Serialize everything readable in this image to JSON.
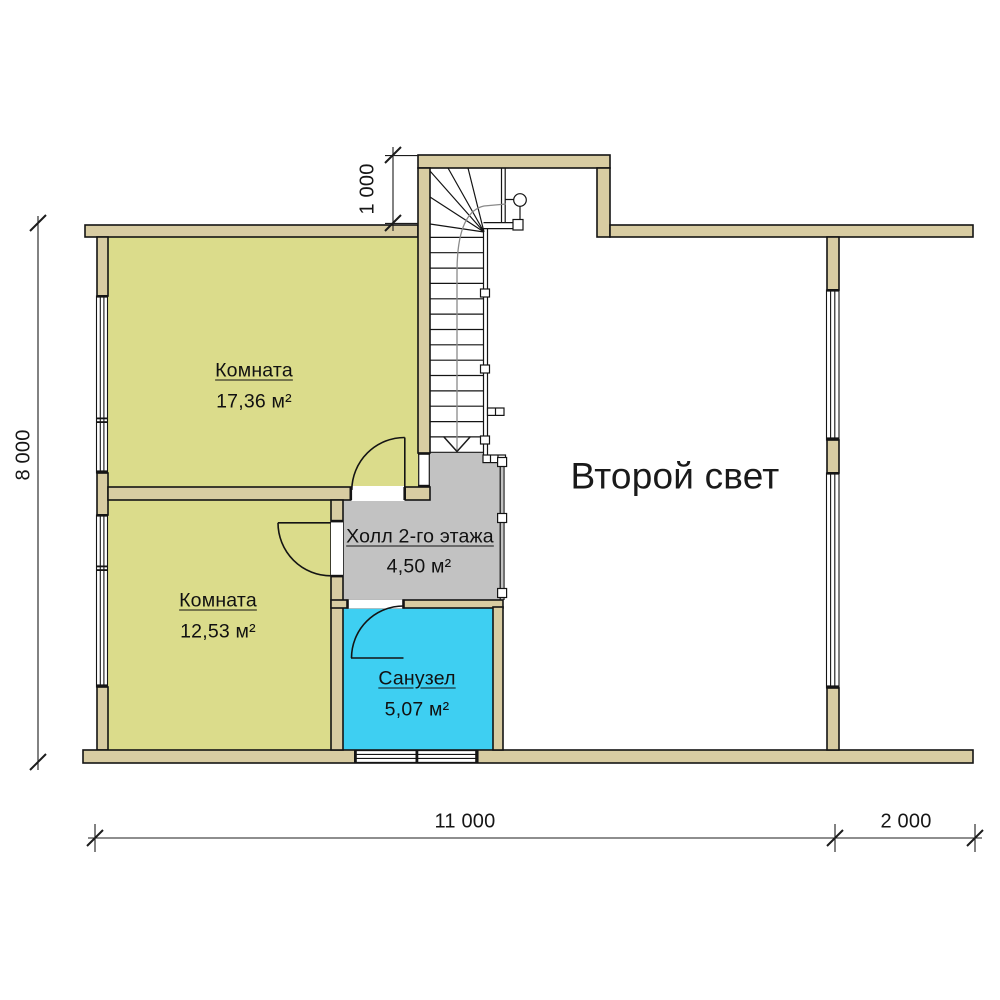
{
  "rooms": [
    {
      "id": "room-1",
      "name": "Комната",
      "area": "17,36 м²"
    },
    {
      "id": "room-2",
      "name": "Комната",
      "area": "12,53 м²"
    },
    {
      "id": "hall",
      "name": "Холл 2-го этажа",
      "area": "4,50 м²"
    },
    {
      "id": "bathroom",
      "name": "Санузел",
      "area": "5,07 м²"
    }
  ],
  "open_space": {
    "label": "Второй свет"
  },
  "dimensions": {
    "left_total": "8 000",
    "stair_offset": "1 000",
    "bottom_main": "11 000",
    "bottom_side": "2 000"
  },
  "colors": {
    "wall": "#d8cca2",
    "room": "#dbdc8b",
    "hall": "#c2c2c2",
    "bathroom": "#3ecff2",
    "outline": "#141414"
  }
}
